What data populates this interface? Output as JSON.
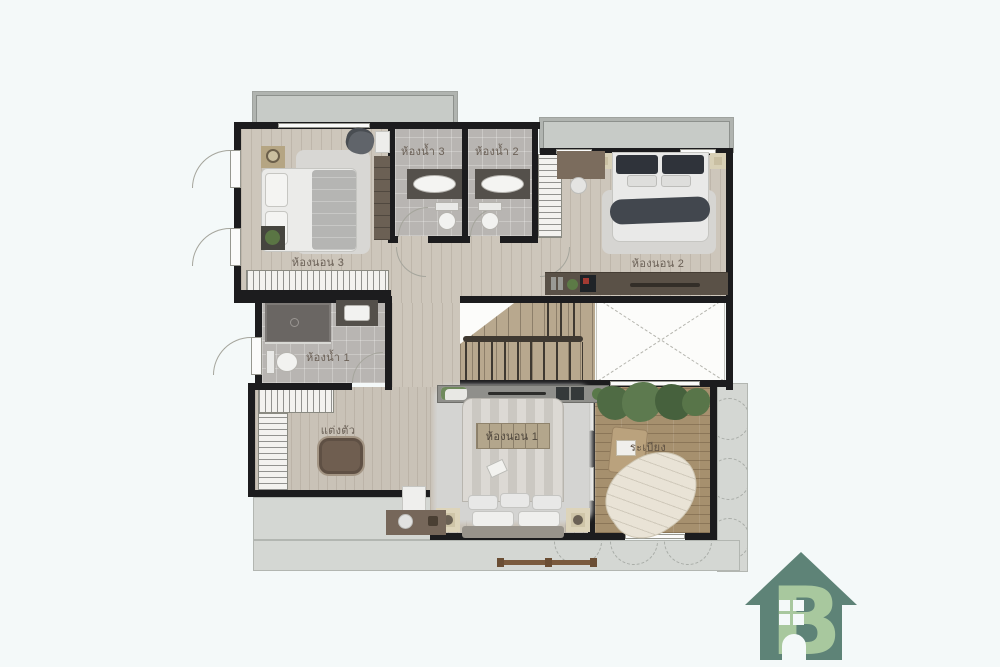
{
  "type": "architectural-floor-plan",
  "rooms": [
    {
      "id": "bedroom-3",
      "label": "ห้องนอน 3"
    },
    {
      "id": "bathroom-3",
      "label": "ห้องน้ำ 3"
    },
    {
      "id": "bathroom-2",
      "label": "ห้องน้ำ 2"
    },
    {
      "id": "bedroom-2",
      "label": "ห้องนอน 2"
    },
    {
      "id": "bathroom-1",
      "label": "ห้องน้ำ 1"
    },
    {
      "id": "dressing-area",
      "label": "แต่งตัว"
    },
    {
      "id": "bedroom-1",
      "label": "ห้องนอน 1"
    },
    {
      "id": "balcony",
      "label": "ระเบียง"
    }
  ],
  "logo": {
    "name": "house-b-logo",
    "letter": "B",
    "house_color": "#5e8377",
    "letter_color": "#a8c89e"
  },
  "colors": {
    "background": "#f4f9f9",
    "wall": "#1c1c1e",
    "wood_floor": "#cdc6bb",
    "tile_floor": "#b8b5b2",
    "deck_floor": "#a6906e",
    "concrete_slab": "#c7cbc7",
    "dark_furniture": "#5a5147",
    "accent_green": "#5c7a46"
  }
}
